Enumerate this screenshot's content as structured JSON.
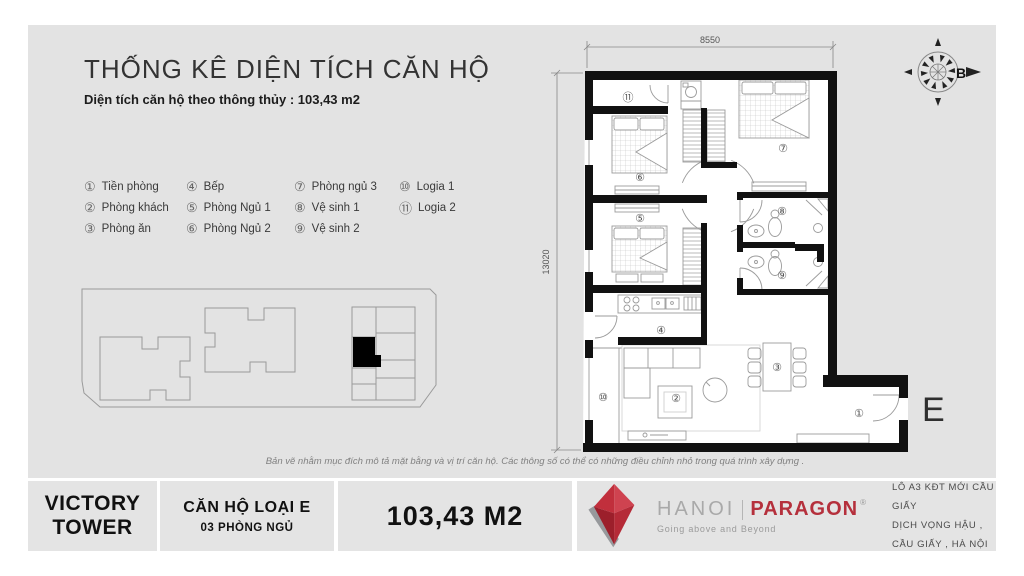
{
  "colors": {
    "panel": "#e3e3e3",
    "wall": "#111111",
    "brand_red": "#b5303c",
    "furniture_gray": "#9b9b9b"
  },
  "header": {
    "title": "THỐNG KÊ DIỆN TÍCH CĂN HỘ",
    "subtitle": "Diện tích căn hộ theo thông thủy : 103,43 m2"
  },
  "legend": {
    "items": [
      {
        "num": "①",
        "label": "Tiền phòng"
      },
      {
        "num": "②",
        "label": "Phòng khách"
      },
      {
        "num": "③",
        "label": "Phòng ăn"
      },
      {
        "num": "④",
        "label": "Bếp"
      },
      {
        "num": "⑤",
        "label": "Phòng Ngủ 1"
      },
      {
        "num": "⑥",
        "label": "Phòng Ngủ 2"
      },
      {
        "num": "⑦",
        "label": "Phòng ngủ 3"
      },
      {
        "num": "⑧",
        "label": "Vệ sinh 1"
      },
      {
        "num": "⑨",
        "label": "Vệ sinh 2"
      },
      {
        "num": "⑩",
        "label": "Logia 1"
      },
      {
        "num": "⑪",
        "label": "Logia 2"
      }
    ]
  },
  "plan": {
    "dim_top": "8550",
    "dim_left": "13020",
    "compass": "B",
    "unit_letter": "E",
    "labels": {
      "tien": "①",
      "khach": "②",
      "an": "③",
      "bep": "④",
      "ngu1": "⑤",
      "ngu2": "⑥",
      "ngu3": "⑦",
      "vs1": "⑧",
      "vs2": "⑨",
      "logia1": "⑩",
      "logia2": "⑪"
    }
  },
  "disclaimer": "Bản vẽ nhằm mục đích mô tả mặt bằng và vị trí căn hộ. Các thông số có thể có những điều chỉnh nhỏ trong quá trình xây dựng .",
  "footer": {
    "project_line1": "VICTORY",
    "project_line2": "TOWER",
    "unit_type": "CĂN HỘ LOẠI E",
    "bedrooms": "03 PHÒNG NGỦ",
    "area": "103,43 M2",
    "brand": {
      "name_gray": "HANOI",
      "name_red": "PARAGON",
      "reg": "®",
      "tagline": "Going above and Beyond"
    },
    "address_line1": "LÔ A3 KĐT MỚI CẦU GIẤY",
    "address_line2": "DỊCH VỌNG HẬU , CẦU GIẤY , HÀ NỘI"
  }
}
